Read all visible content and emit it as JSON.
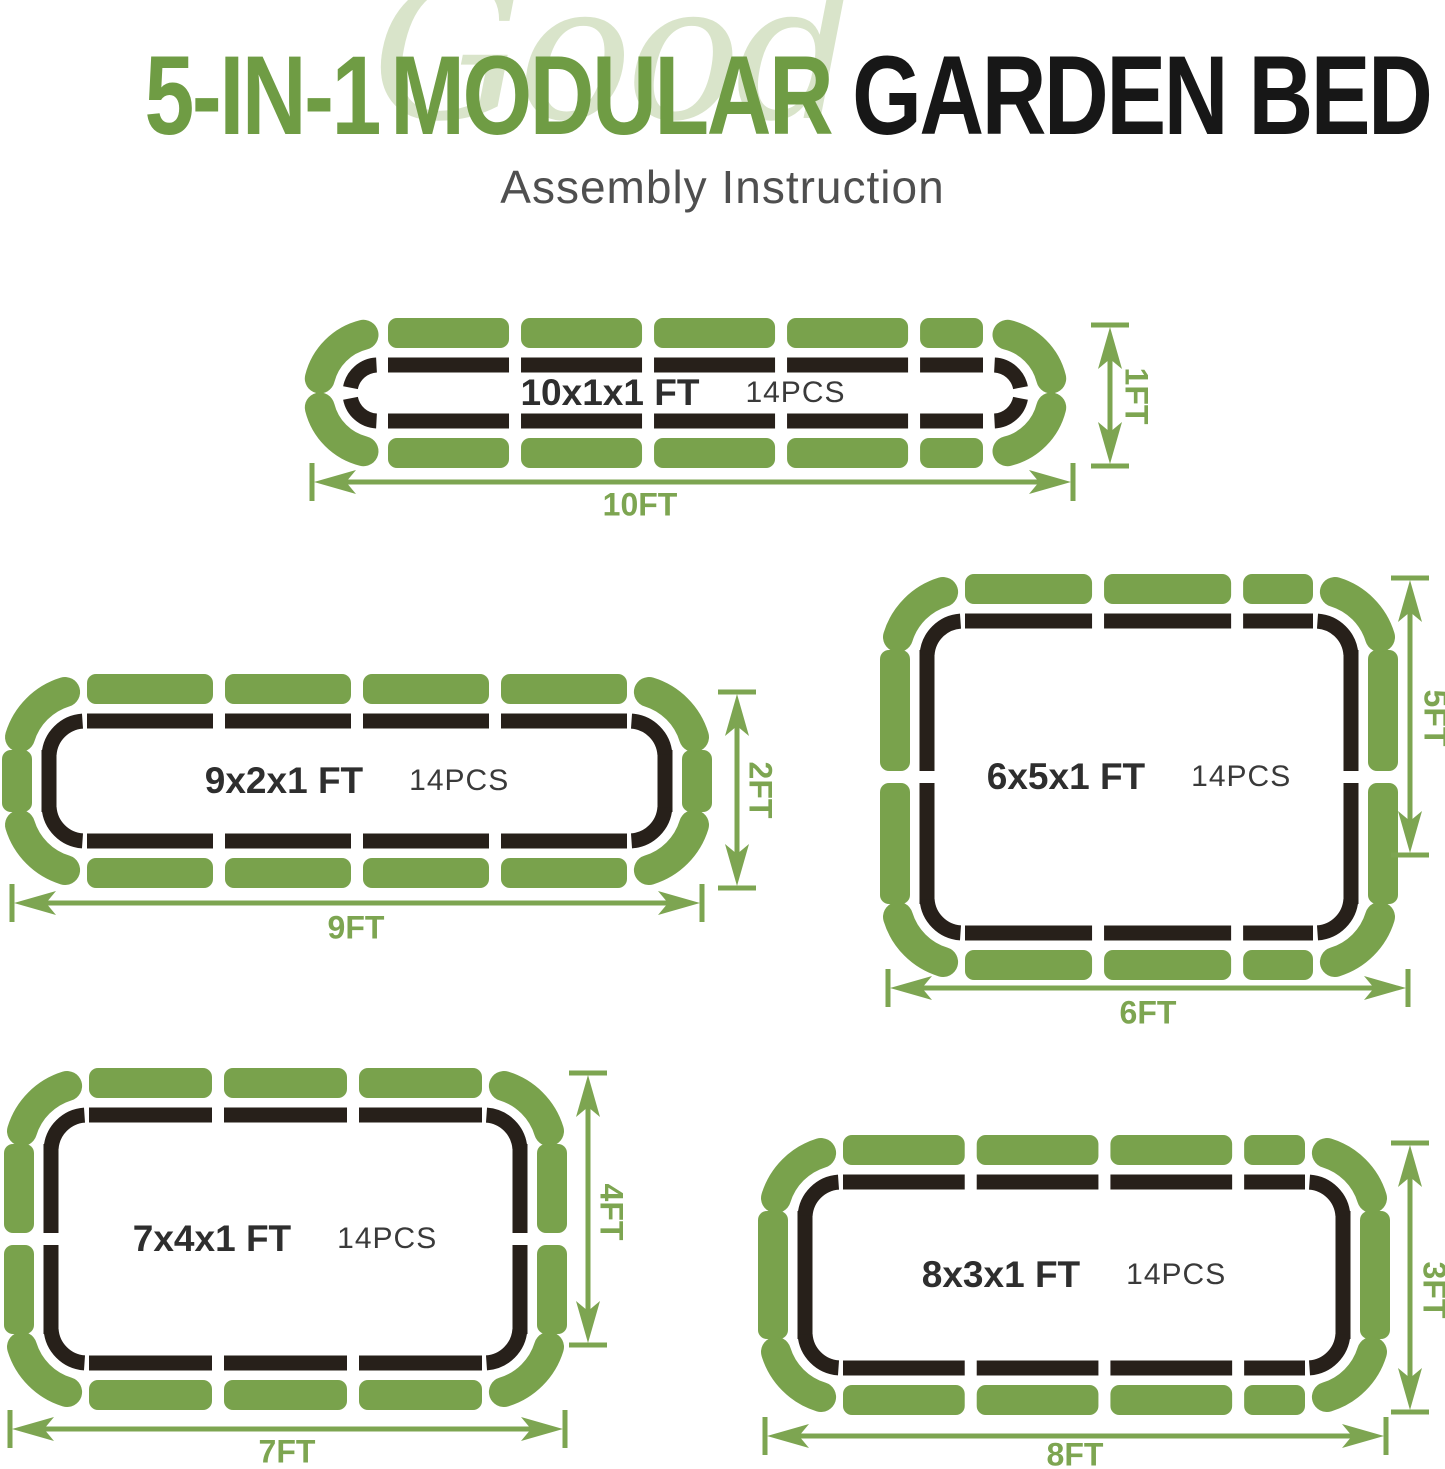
{
  "title": {
    "watermark": "Good",
    "part1": "5-IN-1",
    "part2": "MODULAR",
    "part3": "GARDEN BED",
    "subtitle": "Assembly Instruction"
  },
  "colors": {
    "piece_green": "#79a24c",
    "arrow_green": "#7da551",
    "title_green": "#6f9c44",
    "watermark_green": "#d9e4ca",
    "piece_dark": "#27201a",
    "label_dark": "#2e2e2e",
    "subtitle_gray": "#4f4f4f"
  },
  "beds": [
    {
      "id": "bed-10x1",
      "size_label": "10x1x1 FT",
      "pcs_label": "14PCS",
      "width_label": "10FT",
      "height_label": "1FT",
      "pieces": {
        "top": 5,
        "bottom": 5,
        "left": 0,
        "right": 0,
        "corners": 4,
        "total": 14
      }
    },
    {
      "id": "bed-9x2",
      "size_label": "9x2x1 FT",
      "pcs_label": "14PCS",
      "width_label": "9FT",
      "height_label": "2FT",
      "pieces": {
        "top": 4,
        "bottom": 4,
        "left": 1,
        "right": 1,
        "corners": 4,
        "total": 14
      }
    },
    {
      "id": "bed-6x5",
      "size_label": "6x5x1 FT",
      "pcs_label": "14PCS",
      "width_label": "6FT",
      "height_label": "5FT",
      "pieces": {
        "top": 3,
        "bottom": 3,
        "left": 2,
        "right": 2,
        "corners": 4,
        "total": 14
      }
    },
    {
      "id": "bed-7x4",
      "size_label": "7x4x1 FT",
      "pcs_label": "14PCS",
      "width_label": "7FT",
      "height_label": "4FT",
      "pieces": {
        "top": 3,
        "bottom": 3,
        "left": 2,
        "right": 2,
        "corners": 4,
        "total": 14
      }
    },
    {
      "id": "bed-8x3",
      "size_label": "8x3x1 FT",
      "pcs_label": "14PCS",
      "width_label": "8FT",
      "height_label": "3FT",
      "pieces": {
        "top": 4,
        "bottom": 4,
        "left": 1,
        "right": 1,
        "corners": 4,
        "total": 14
      }
    }
  ]
}
